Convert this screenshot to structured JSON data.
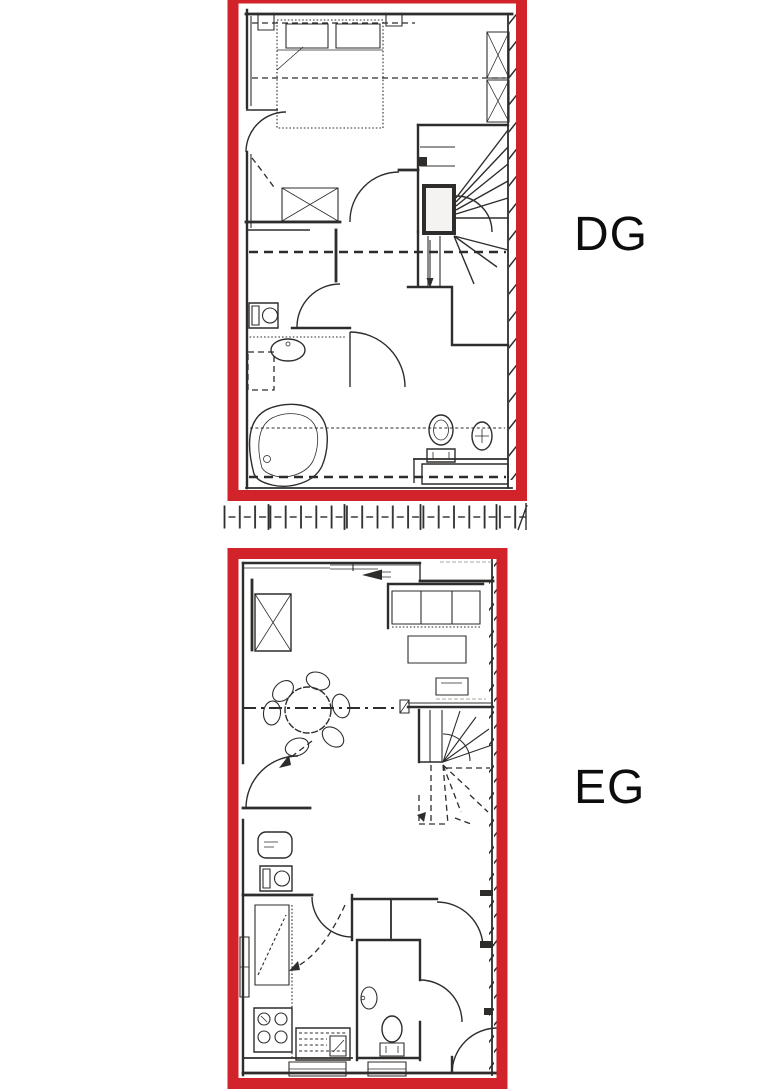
{
  "floors": [
    {
      "id": "dg",
      "label": "DG"
    },
    {
      "id": "eg",
      "label": "EG"
    }
  ],
  "colors": {
    "frame_red": "#d2232b",
    "ink": "#2f2d2b",
    "paper": "#ffffff"
  }
}
